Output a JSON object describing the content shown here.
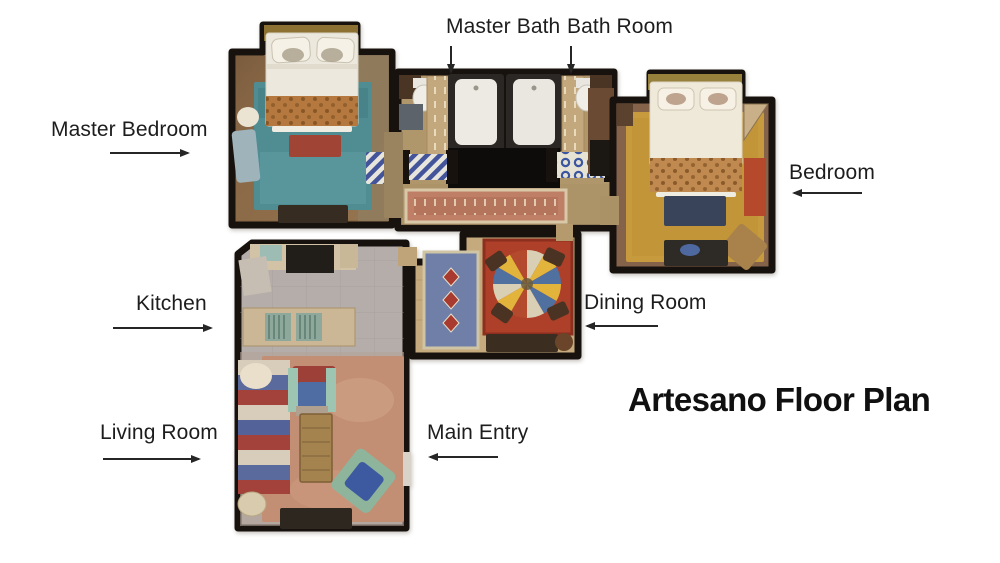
{
  "title": "Artesano Floor Plan",
  "labels": {
    "master_bath": {
      "text": "Master Bath",
      "arrow": "down"
    },
    "bath_room": {
      "text": "Bath Room",
      "arrow": "down"
    },
    "master_bedroom": {
      "text": "Master Bedroom",
      "arrow": "right"
    },
    "bedroom": {
      "text": "Bedroom",
      "arrow": "left"
    },
    "kitchen": {
      "text": "Kitchen",
      "arrow": "right"
    },
    "dining_room": {
      "text": "Dining Room",
      "arrow": "left"
    },
    "living_room": {
      "text": "Living Room",
      "arrow": "right"
    },
    "main_entry": {
      "text": "Main Entry",
      "arrow": "left"
    }
  },
  "palette": {
    "wall": "#17120e",
    "master_floor": "#8a6847",
    "bath_floor": "#b0976b",
    "bedroom_floor": "#85634a",
    "kitchen_floor": "#b5adaa",
    "dining_floor": "#c5aa7e",
    "teal_rug": "#4f8d93",
    "gold_rug": "#c79a3d",
    "salmon_rug": "#c28f74",
    "hall_runner": "#bf7f67",
    "dining_blue_rug": "#6f7fa8",
    "dining_red_rug": "#ae3f28"
  }
}
